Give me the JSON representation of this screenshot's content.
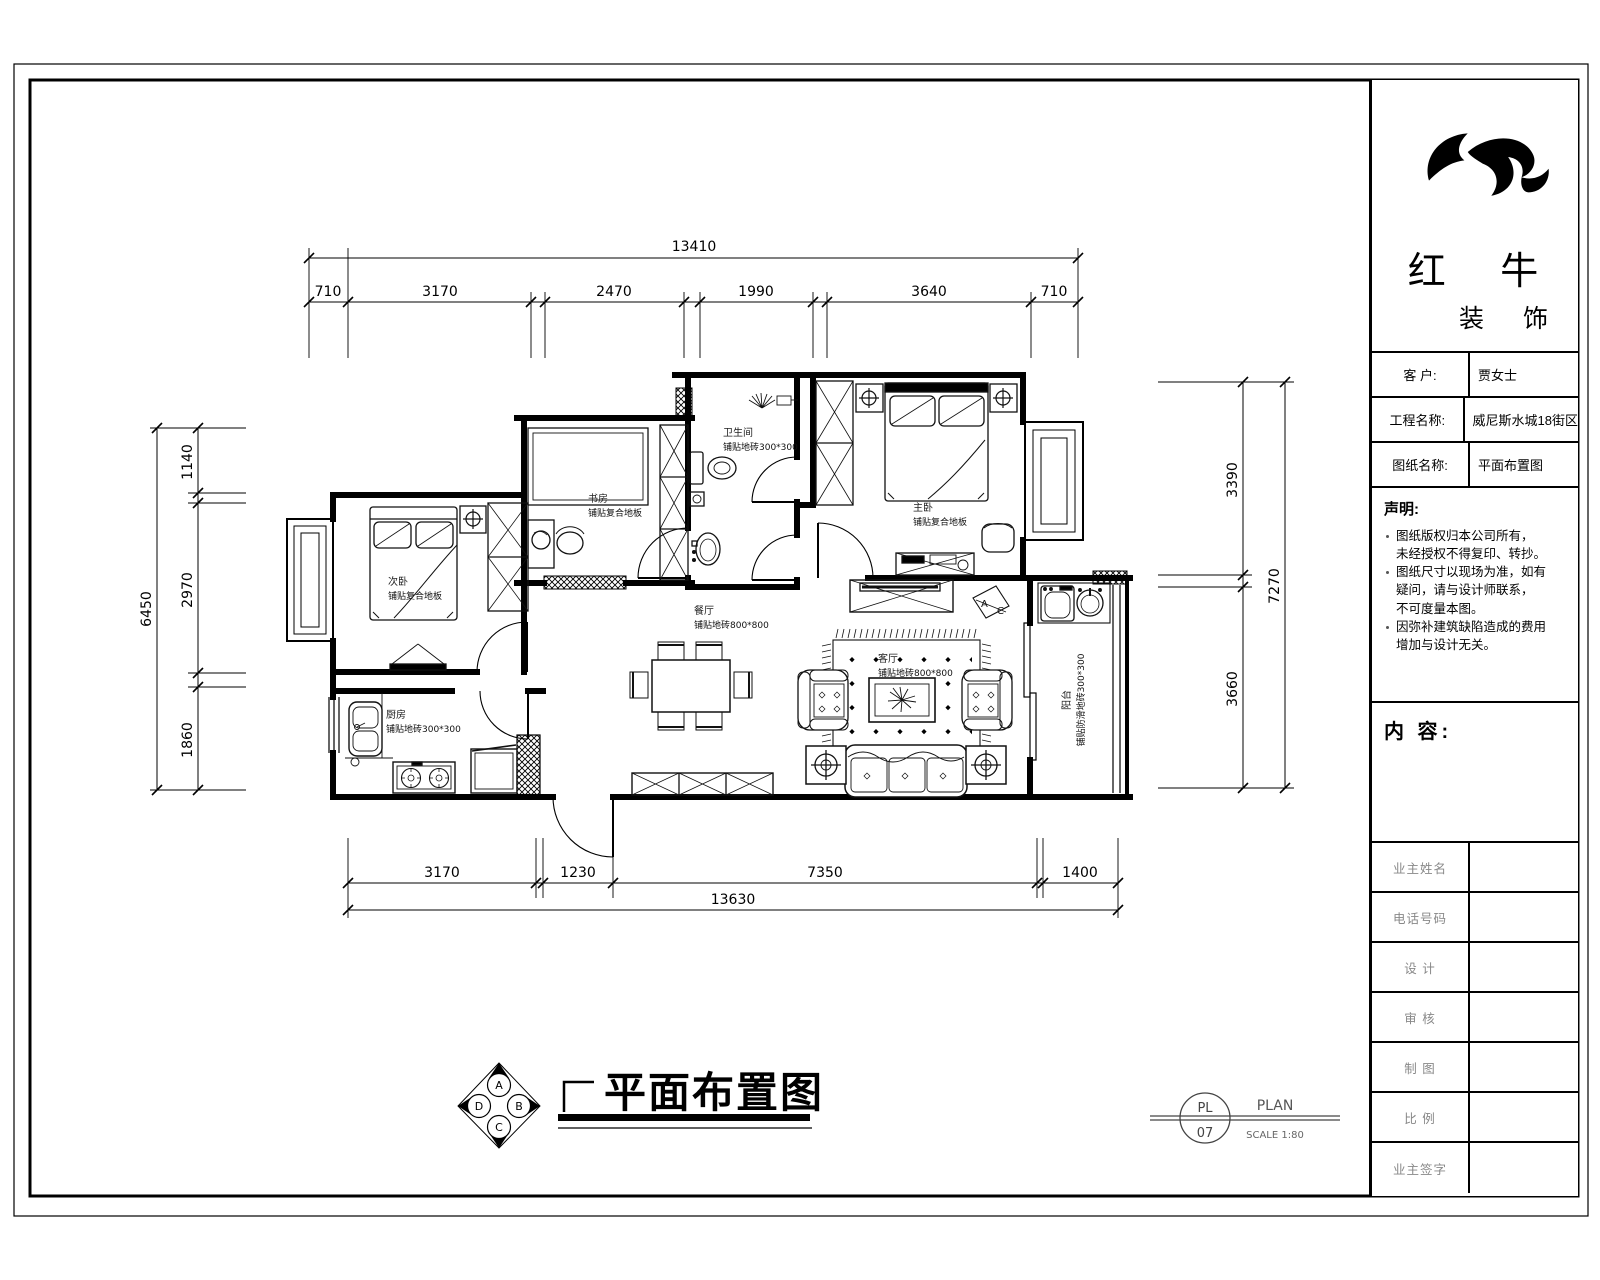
{
  "title_block": {
    "company": {
      "name_primary": "红 牛",
      "name_secondary": "装 饰"
    },
    "rows": [
      {
        "label": "客  户:",
        "value": "贾女士"
      },
      {
        "label": "工程名称:",
        "value": "威尼斯水城18街区"
      },
      {
        "label": "图纸名称:",
        "value": "平面布置图"
      }
    ],
    "declaration": {
      "title": "声明:",
      "notes": [
        {
          "lines": [
            "图纸版权归本公司所有，",
            "未经授权不得复印、转抄。"
          ]
        },
        {
          "lines": [
            "图纸尺寸以现场为准，如有",
            "疑问，请与设计师联系，",
            "不可度量本图。"
          ]
        },
        {
          "lines": [
            "因弥补建筑缺陷造成的费用",
            "增加与设计无关。"
          ]
        }
      ]
    },
    "content_label": "内 容:",
    "sign_rows": [
      "业主姓名",
      "电话号码",
      "设  计",
      "审  核",
      "制  图",
      "比  例",
      "业主签字"
    ]
  },
  "plan": {
    "rooms": {
      "bedroom2": {
        "name": "次卧",
        "floor": "铺贴复合地板"
      },
      "study": {
        "name": "书房",
        "floor": "铺贴复合地板"
      },
      "bathroom": {
        "name": "卫生间",
        "floor": "铺贴地砖300*300"
      },
      "master": {
        "name": "主卧",
        "floor": "铺贴复合地板"
      },
      "dining": {
        "name": "餐厅",
        "floor": "铺贴地砖800*800"
      },
      "living": {
        "name": "客厅",
        "floor": "铺贴地砖800*800"
      },
      "kitchen": {
        "name": "厨房",
        "floor": "铺贴地砖300*300"
      },
      "balcony": {
        "name": "阳台",
        "floor": "铺贴防滑地砖300*300"
      }
    },
    "dimensions": {
      "top": {
        "total": "13410",
        "segments": [
          "710",
          "3170",
          "2470",
          "1990",
          "3640",
          "710"
        ]
      },
      "bottom": {
        "total": "13630",
        "segments": [
          "3170",
          "1230",
          "7350",
          "1400"
        ]
      },
      "left": {
        "total": "6450",
        "segments": [
          "1140",
          "2970",
          "1860"
        ]
      },
      "right": {
        "total": "7270",
        "segments": [
          "3390",
          "3660"
        ]
      }
    },
    "ac": {
      "a": "A",
      "c": "C"
    },
    "compass": {
      "top": "A",
      "right": "B",
      "bottom": "C",
      "left": "D"
    }
  },
  "footer": {
    "title": "平面布置图",
    "sheet_code_top": "PL",
    "sheet_code_bottom": "07",
    "plan_word": "PLAN",
    "scale_text": "SCALE 1:80"
  }
}
